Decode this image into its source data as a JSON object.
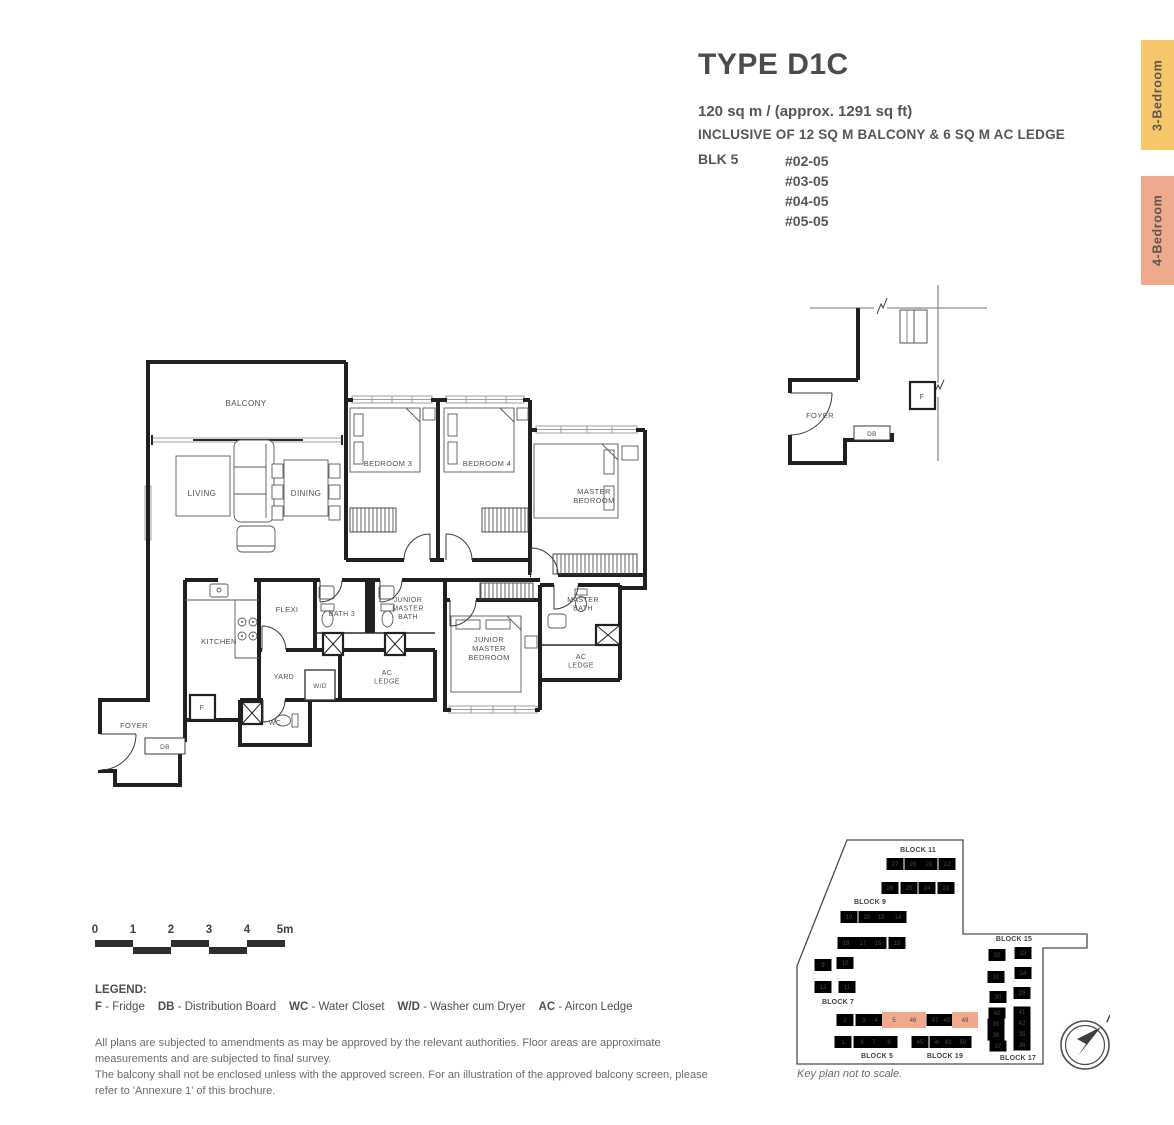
{
  "header": {
    "title": "TYPE D1C",
    "area": "120 sq m / (approx. 1291 sq ft)",
    "inclusive": "INCLUSIVE OF 12 SQ M BALCONY & 6 SQ M AC LEDGE",
    "block_label": "BLK 5",
    "units": [
      "#02-05",
      "#03-05",
      "#04-05",
      "#05-05"
    ]
  },
  "tabs": [
    {
      "label": "3-Bedroom",
      "color": "#F5C76A"
    },
    {
      "label": "4-Bedroom",
      "color": "#EFA98D"
    }
  ],
  "floorplan": {
    "labels": [
      {
        "lines": [
          "BALCONY"
        ],
        "x": 158,
        "y": 58,
        "size": 8
      },
      {
        "lines": [
          "LIVING"
        ],
        "x": 114,
        "y": 148,
        "size": 8
      },
      {
        "lines": [
          "DINING"
        ],
        "x": 218,
        "y": 148,
        "size": 8
      },
      {
        "lines": [
          "BEDROOM 3"
        ],
        "x": 300,
        "y": 118,
        "size": 7.5
      },
      {
        "lines": [
          "BEDROOM 4"
        ],
        "x": 399,
        "y": 118,
        "size": 7.5
      },
      {
        "lines": [
          "MASTER",
          "BEDROOM"
        ],
        "x": 506,
        "y": 146,
        "size": 7.5
      },
      {
        "lines": [
          "KITCHEN"
        ],
        "x": 131,
        "y": 296,
        "size": 7.5
      },
      {
        "lines": [
          "FLEXI"
        ],
        "x": 199,
        "y": 264,
        "size": 7.5
      },
      {
        "lines": [
          "BATH 3"
        ],
        "x": 254,
        "y": 268,
        "size": 7
      },
      {
        "lines": [
          "JUNIOR",
          "MASTER",
          "BATH"
        ],
        "x": 320,
        "y": 254,
        "size": 7
      },
      {
        "lines": [
          "JUNIOR",
          "MASTER",
          "BEDROOM"
        ],
        "x": 401,
        "y": 294,
        "size": 7.5
      },
      {
        "lines": [
          "MASTER",
          "BATH"
        ],
        "x": 495,
        "y": 254,
        "size": 7
      },
      {
        "lines": [
          "AC",
          "LEDGE"
        ],
        "x": 493,
        "y": 311,
        "size": 7
      },
      {
        "lines": [
          "AC",
          "LEDGE"
        ],
        "x": 299,
        "y": 327,
        "size": 7
      },
      {
        "lines": [
          "YARD"
        ],
        "x": 196,
        "y": 331,
        "size": 7
      },
      {
        "lines": [
          "W/D"
        ],
        "x": 232,
        "y": 340,
        "size": 6.5
      },
      {
        "lines": [
          "F"
        ],
        "x": 114,
        "y": 362,
        "size": 7
      },
      {
        "lines": [
          "WC"
        ],
        "x": 187,
        "y": 377,
        "size": 7
      },
      {
        "lines": [
          "FOYER"
        ],
        "x": 46,
        "y": 380,
        "size": 7.5
      },
      {
        "lines": [
          "DB"
        ],
        "x": 77,
        "y": 401,
        "size": 6.5
      }
    ]
  },
  "upper_plan": {
    "labels": [
      {
        "lines": [
          "FOYER"
        ],
        "x": 40,
        "y": 135,
        "size": 7.5
      },
      {
        "lines": [
          "DB"
        ],
        "x": 92,
        "y": 153,
        "size": 6.5
      },
      {
        "lines": [
          "F"
        ],
        "x": 142,
        "y": 116,
        "size": 7
      }
    ]
  },
  "scalebar": {
    "ticks": [
      "0",
      "1",
      "2",
      "3",
      "4",
      "5m"
    ]
  },
  "legend": {
    "heading": "LEGEND:",
    "items": [
      {
        "abbr": "F",
        "desc": "Fridge"
      },
      {
        "abbr": "DB",
        "desc": "Distribution Board"
      },
      {
        "abbr": "WC",
        "desc": "Water Closet"
      },
      {
        "abbr": "W/D",
        "desc": "Washer cum Dryer"
      },
      {
        "abbr": "AC",
        "desc": "Aircon Ledge"
      }
    ]
  },
  "disclaimer": [
    "All plans are subjected to amendments as may be approved by the relevant authorities. Floor areas are approximate measurements and are subjected to final survey.",
    "The balcony shall not be enclosed unless with the approved screen. For an illustration of the approved balcony screen, please refer to 'Annexure 1' of this brochure."
  ],
  "keyplan": {
    "caption": "Key plan not to scale.",
    "compass_label": "N",
    "highlight_color": "#F1A98C",
    "blocks": [
      {
        "name": "BLOCK 11",
        "lx": 128,
        "ly": 16,
        "units": [
          {
            "n": "27",
            "x": 105,
            "y": 28
          },
          {
            "n": "28",
            "x": 123,
            "y": 28
          },
          {
            "n": "21",
            "x": 139,
            "y": 28
          },
          {
            "n": "22",
            "x": 157,
            "y": 28
          },
          {
            "n": "26",
            "x": 100,
            "y": 52
          },
          {
            "n": "25",
            "x": 119,
            "y": 52
          },
          {
            "n": "24",
            "x": 137,
            "y": 52
          },
          {
            "n": "23",
            "x": 156,
            "y": 52
          }
        ]
      },
      {
        "name": "BLOCK 9",
        "lx": 80,
        "ly": 68,
        "units": [
          {
            "n": "19",
            "x": 59,
            "y": 81
          },
          {
            "n": "20",
            "x": 77,
            "y": 81
          },
          {
            "n": "13",
            "x": 91,
            "y": 81
          },
          {
            "n": "14",
            "x": 108,
            "y": 81
          },
          {
            "n": "18",
            "x": 56,
            "y": 107
          },
          {
            "n": "17",
            "x": 73,
            "y": 107
          },
          {
            "n": "16",
            "x": 88,
            "y": 107
          },
          {
            "n": "15",
            "x": 107,
            "y": 107
          }
        ]
      },
      {
        "name": "BLOCK 7",
        "lx": 48,
        "ly": 168,
        "units": [
          {
            "n": "9",
            "x": 33,
            "y": 129
          },
          {
            "n": "10",
            "x": 55,
            "y": 127
          },
          {
            "n": "12",
            "x": 33,
            "y": 151
          },
          {
            "n": "11",
            "x": 57,
            "y": 151
          }
        ]
      },
      {
        "name": "BLOCK 5",
        "lx": 87,
        "ly": 222,
        "units": [
          {
            "n": "2",
            "x": 55,
            "y": 184
          },
          {
            "n": "3",
            "x": 74,
            "y": 184
          },
          {
            "n": "4",
            "x": 86,
            "y": 184
          },
          {
            "n": "5",
            "x": 104,
            "y": 184,
            "hl": true,
            "w": 24,
            "h": 16
          },
          {
            "n": "1",
            "x": 53,
            "y": 206
          },
          {
            "n": "8",
            "x": 72,
            "y": 206
          },
          {
            "n": "7",
            "x": 84,
            "y": 206
          },
          {
            "n": "6",
            "x": 99,
            "y": 206
          }
        ]
      },
      {
        "name": "BLOCK 19",
        "lx": 155,
        "ly": 222,
        "units": [
          {
            "n": "46",
            "x": 123,
            "y": 184,
            "hl": true,
            "w": 26,
            "h": 16
          },
          {
            "n": "47",
            "x": 145,
            "y": 184
          },
          {
            "n": "48",
            "x": 157,
            "y": 184
          },
          {
            "n": "49",
            "x": 175,
            "y": 184,
            "hl": true,
            "w": 26,
            "h": 16
          },
          {
            "n": "45",
            "x": 130,
            "y": 206
          },
          {
            "n": "44",
            "x": 148,
            "y": 206
          },
          {
            "n": "43",
            "x": 158,
            "y": 206
          },
          {
            "n": "50",
            "x": 173,
            "y": 206
          }
        ]
      },
      {
        "name": "BLOCK 15",
        "lx": 224,
        "ly": 105,
        "units": [
          {
            "n": "32",
            "x": 207,
            "y": 119
          },
          {
            "n": "33",
            "x": 233,
            "y": 117
          },
          {
            "n": "31",
            "x": 206,
            "y": 141
          },
          {
            "n": "34",
            "x": 233,
            "y": 137
          },
          {
            "n": "30",
            "x": 208,
            "y": 161
          },
          {
            "n": "29",
            "x": 232,
            "y": 157
          }
        ]
      },
      {
        "name": "BLOCK 17",
        "lx": 228,
        "ly": 224,
        "uh": 11,
        "units": [
          {
            "n": "40",
            "x": 207,
            "y": 177
          },
          {
            "n": "41",
            "x": 232,
            "y": 176
          },
          {
            "n": "39",
            "x": 206,
            "y": 188
          },
          {
            "n": "42",
            "x": 232,
            "y": 187
          },
          {
            "n": "38",
            "x": 206,
            "y": 199
          },
          {
            "n": "35",
            "x": 232,
            "y": 198
          },
          {
            "n": "37",
            "x": 208,
            "y": 210
          },
          {
            "n": "36",
            "x": 232,
            "y": 209
          }
        ]
      }
    ]
  }
}
